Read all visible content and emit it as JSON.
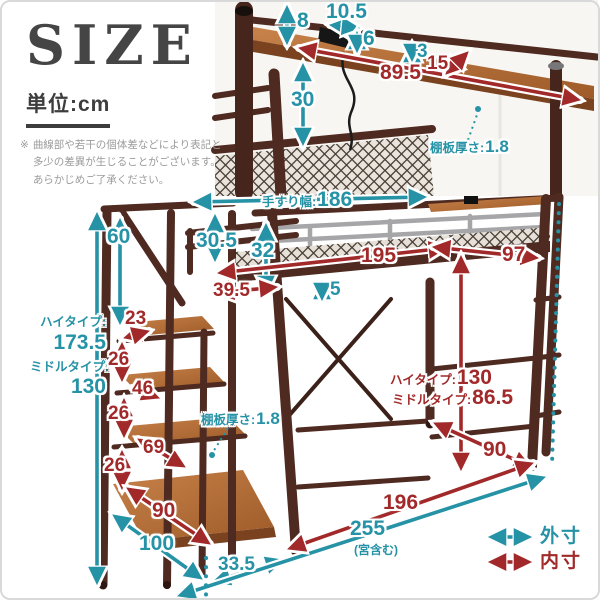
{
  "header": {
    "title": "SIZE",
    "unit": "単位:cm",
    "note_mark": "※",
    "note_lines": [
      "曲線部や若干の個体差などにより表記と",
      "多少の差異が生じることがございます。",
      "あらかじめご了承ください。"
    ]
  },
  "legend": {
    "outer_label": "外寸",
    "inner_label": "内寸"
  },
  "colors": {
    "outer": "#2692a6",
    "inner": "#a2292a"
  },
  "shelf_detail": {
    "post_top": "8",
    "tap_width": "10.5",
    "tap_height": "6",
    "clearance": "3",
    "inner_width": "89.5",
    "depth": "15",
    "height": "30",
    "board_thickness_label": "棚板厚さ:",
    "board_thickness_value": "1.8"
  },
  "loft": {
    "handrail_width_label": "手すり幅:",
    "handrail_width_value": "186",
    "guard_upper": "30.5",
    "guard_total": "32",
    "deck_inset": "39.5",
    "inner_length": "195",
    "frame_thickness": "5",
    "inner_width": "97",
    "clearance_high_label": "ハイタイプ:",
    "clearance_high_value": "130",
    "clearance_middle_label": "ミドルタイプ:",
    "clearance_middle_value": "86.5",
    "inner_depth": "90"
  },
  "stairs": {
    "rail_height": "60",
    "total_high_label": "ハイタイプ:",
    "total_high_value": "173.5",
    "total_middle_label": "ミドルタイプ:",
    "total_middle_value": "130",
    "step1_depth": "23",
    "riser1": "26",
    "step2_depth": "46",
    "riser2": "26",
    "step3_depth": "69",
    "riser3": "26",
    "step4_depth": "90",
    "board_thickness_label": "棚板厚さ:",
    "board_thickness_value": "1.8",
    "base_depth": "100",
    "base_width": "33.5"
  },
  "footprint": {
    "inner_length": "196",
    "outer_length": "255",
    "outer_length_note": "(宮含む)"
  }
}
